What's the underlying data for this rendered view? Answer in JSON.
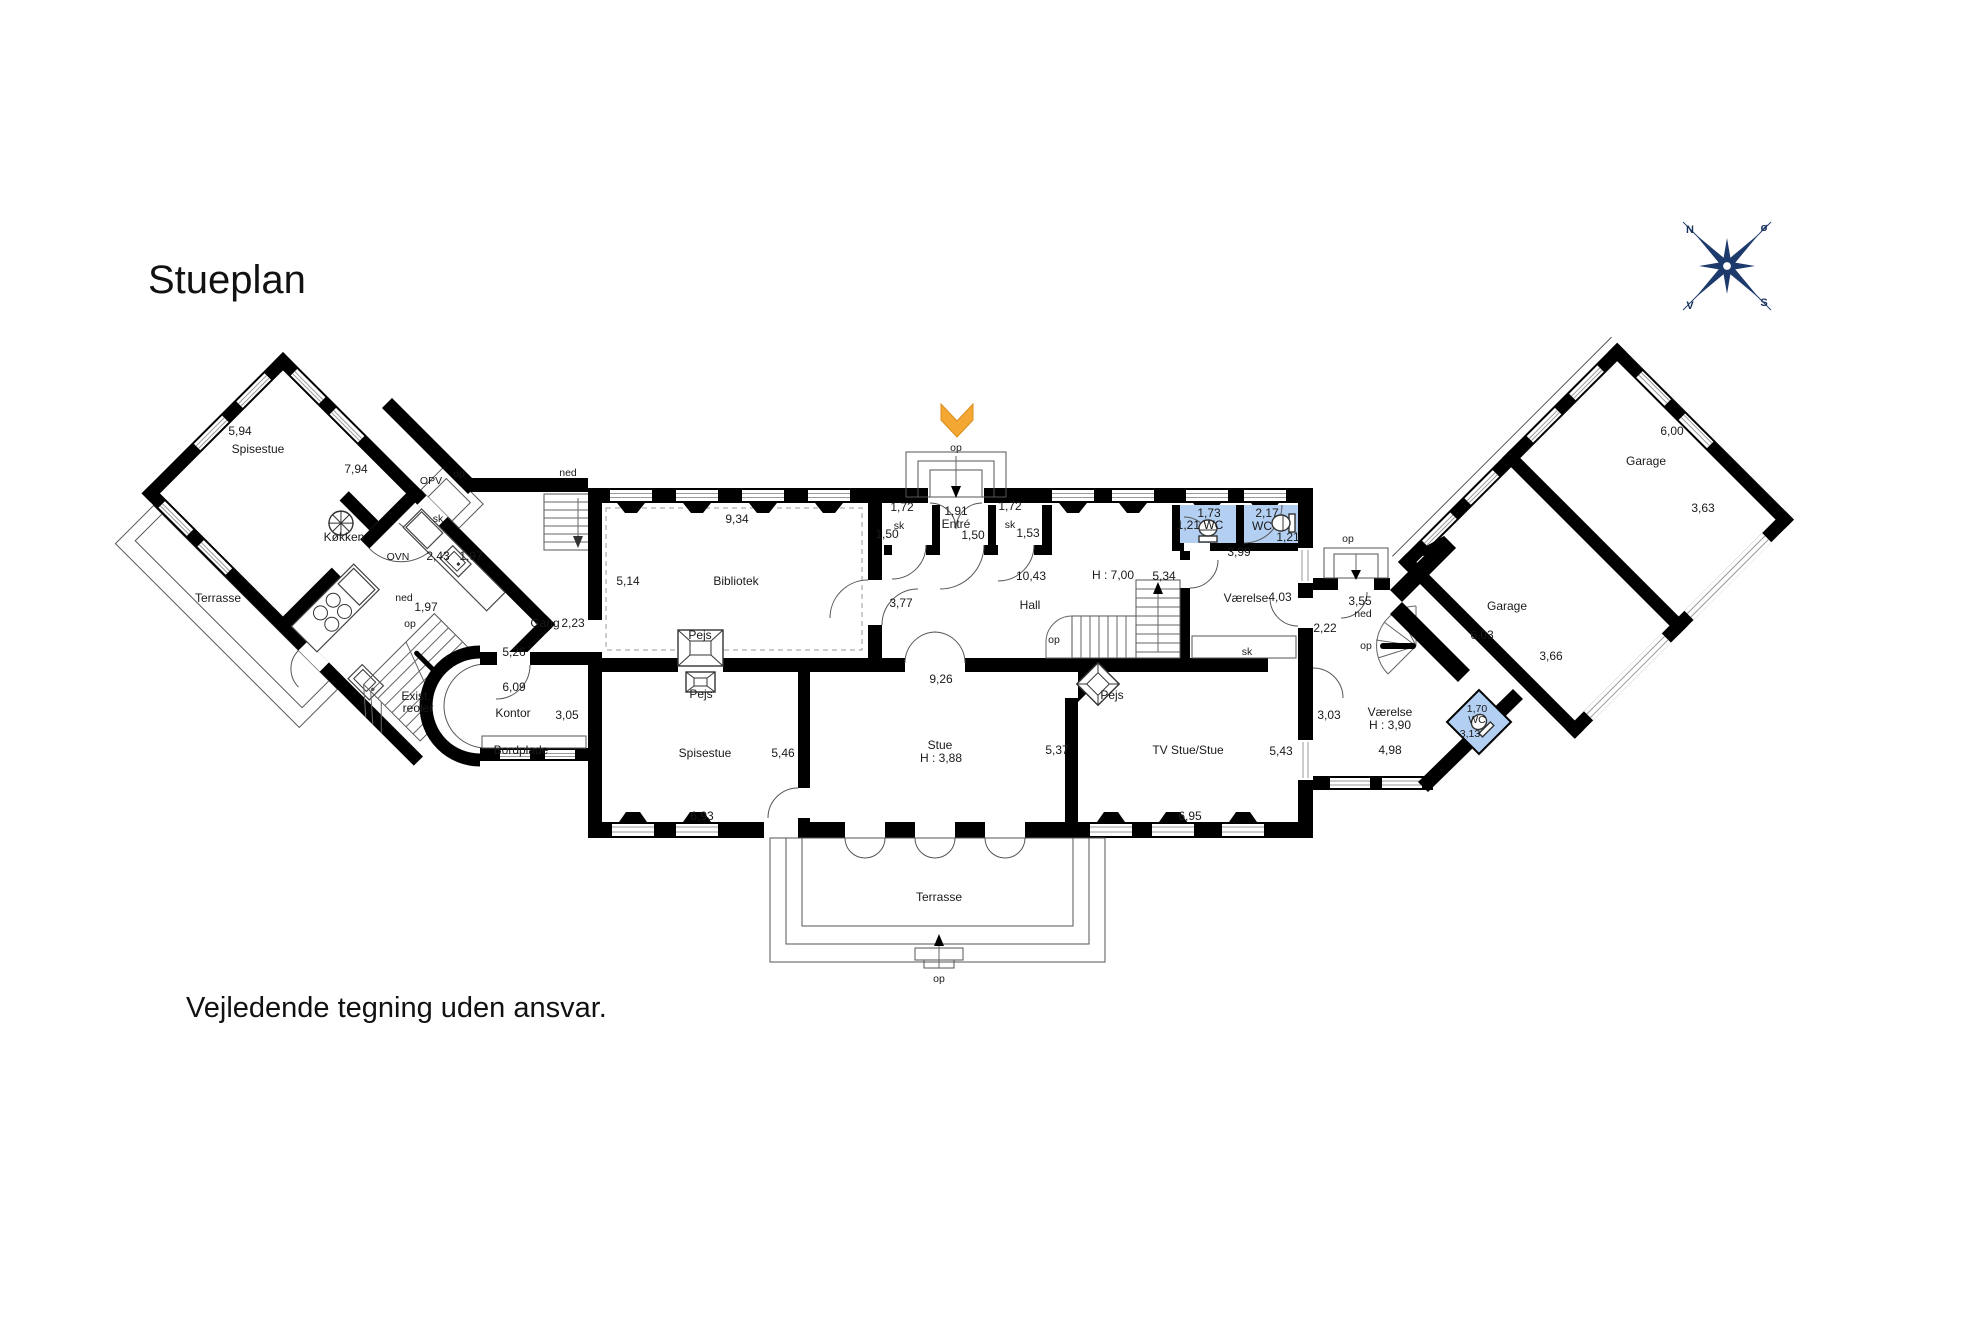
{
  "page": {
    "title": "Stueplan",
    "disclaimer": "Vejledende tegning uden ansvar."
  },
  "compass": {
    "north": "N",
    "east": "ø",
    "south": "S",
    "west": "V"
  },
  "colors": {
    "wall": "#000000",
    "wc_room_fill": "#b3cff2",
    "entrance_marker_orange": "#f4a733",
    "compass_navy": "#1c3a6b"
  },
  "plan": {
    "labels": [
      {
        "n": "dim-spisestue-width",
        "t": "5,94",
        "x": 240,
        "y": 435
      },
      {
        "n": "room-spisestue-wing",
        "t": "Spisestue",
        "x": 258,
        "y": 453
      },
      {
        "n": "dim-spisestue-length",
        "t": "7,94",
        "x": 356,
        "y": 473
      },
      {
        "n": "fixture-opv",
        "t": "OPV",
        "x": 431,
        "y": 484,
        "s": 11
      },
      {
        "n": "room-kokken",
        "t": "Køkken",
        "x": 344,
        "y": 541
      },
      {
        "n": "fixture-ovn",
        "t": "OVN",
        "x": 398,
        "y": 560,
        "s": 11
      },
      {
        "n": "closet-sk-kitchen",
        "t": "sk",
        "x": 438,
        "y": 522,
        "s": 11
      },
      {
        "n": "dim-243",
        "t": "2,43",
        "x": 438,
        "y": 560
      },
      {
        "n": "dim-197a",
        "t": "1,97",
        "x": 471,
        "y": 560
      },
      {
        "n": "stair-ned-kitchen",
        "t": "ned",
        "x": 404,
        "y": 601,
        "s": 11
      },
      {
        "n": "dim-197b",
        "t": "1,97",
        "x": 426,
        "y": 611
      },
      {
        "n": "stair-op-kitchen",
        "t": "op",
        "x": 410,
        "y": 627,
        "s": 11
      },
      {
        "n": "stair-ned-bibliotek",
        "t": "ned",
        "x": 568,
        "y": 476,
        "s": 11
      },
      {
        "n": "entry-op-kitchen",
        "t": "op",
        "x": 459,
        "y": 477,
        "s": 11
      },
      {
        "n": "area-terrasse-wing",
        "t": "Terrasse",
        "x": 218,
        "y": 602
      },
      {
        "n": "room-gang",
        "t": "Gang",
        "x": 545,
        "y": 627
      },
      {
        "n": "dim-gang-223",
        "t": "2,23",
        "x": 573,
        "y": 627
      },
      {
        "n": "dim-526",
        "t": "5,26",
        "x": 514,
        "y": 656
      },
      {
        "n": "dim-609",
        "t": "6,09",
        "x": 514,
        "y": 691
      },
      {
        "n": "note-exist",
        "t": "Exist.",
        "x": 416,
        "y": 700
      },
      {
        "n": "note-reoler",
        "t": "reoler",
        "x": 418,
        "y": 712
      },
      {
        "n": "room-kontor",
        "t": "Kontor",
        "x": 513,
        "y": 717
      },
      {
        "n": "dim-305",
        "t": "3,05",
        "x": 567,
        "y": 719
      },
      {
        "n": "fixture-bordplade",
        "t": "Bordplade",
        "x": 521,
        "y": 754
      },
      {
        "n": "dim-934",
        "t": "9,34",
        "x": 737,
        "y": 523
      },
      {
        "n": "dim-514",
        "t": "5,14",
        "x": 628,
        "y": 585
      },
      {
        "n": "room-bibliotek",
        "t": "Bibliotek",
        "x": 736,
        "y": 585
      },
      {
        "n": "fixture-pejs-bibliotek",
        "t": "Pejs",
        "x": 700,
        "y": 639
      },
      {
        "n": "fixture-pejs-spisestue",
        "t": "Pejs",
        "x": 701,
        "y": 698
      },
      {
        "n": "dim-377",
        "t": "3,77",
        "x": 901,
        "y": 607
      },
      {
        "n": "dim-sk1-172",
        "t": "1,72",
        "x": 902,
        "y": 511
      },
      {
        "n": "closet-sk1",
        "t": "sk",
        "x": 899,
        "y": 529,
        "s": 11
      },
      {
        "n": "dim-sk1-150",
        "t": "1,50",
        "x": 887,
        "y": 538
      },
      {
        "n": "dim-entre-191",
        "t": "1,91",
        "x": 956,
        "y": 515
      },
      {
        "n": "room-entre",
        "t": "Entré",
        "x": 956,
        "y": 528
      },
      {
        "n": "dim-entre-150",
        "t": "1,50",
        "x": 973,
        "y": 539
      },
      {
        "n": "dim-sk2-172",
        "t": "1,72",
        "x": 1010,
        "y": 510
      },
      {
        "n": "closet-sk2",
        "t": "sk",
        "x": 1010,
        "y": 528,
        "s": 11
      },
      {
        "n": "dim-sk2-153",
        "t": "1,53",
        "x": 1028,
        "y": 537
      },
      {
        "n": "entry-op-main",
        "t": "op",
        "x": 956,
        "y": 451,
        "s": 11
      },
      {
        "n": "dim-1043",
        "t": "10,43",
        "x": 1031,
        "y": 580
      },
      {
        "n": "room-hall",
        "t": "Hall",
        "x": 1030,
        "y": 609
      },
      {
        "n": "dim-h700",
        "t": "H : 7,00",
        "x": 1113,
        "y": 579
      },
      {
        "n": "dim-534",
        "t": "5,34",
        "x": 1164,
        "y": 580
      },
      {
        "n": "stair-op-hall",
        "t": "op",
        "x": 1054,
        "y": 643,
        "s": 11
      },
      {
        "n": "dim-wc1-173",
        "t": "1,73",
        "x": 1209,
        "y": 517
      },
      {
        "n": "room-wc1",
        "t": "1,21 WC",
        "x": 1200,
        "y": 529
      },
      {
        "n": "dim-wc2-217",
        "t": "2,17",
        "x": 1267,
        "y": 517
      },
      {
        "n": "room-wc2",
        "t": "WC",
        "x": 1262,
        "y": 530
      },
      {
        "n": "dim-wc2-121",
        "t": "1,21",
        "x": 1288,
        "y": 541
      },
      {
        "n": "dim-399",
        "t": "3,99",
        "x": 1239,
        "y": 556
      },
      {
        "n": "room-vaerelse-1",
        "t": "Værelse",
        "x": 1246,
        "y": 602
      },
      {
        "n": "dim-403",
        "t": "4,03",
        "x": 1280,
        "y": 601
      },
      {
        "n": "dim-222",
        "t": "2,22",
        "x": 1325,
        "y": 632
      },
      {
        "n": "closet-sk3",
        "t": "sk",
        "x": 1247,
        "y": 655,
        "s": 11
      },
      {
        "n": "entry-op-right",
        "t": "op",
        "x": 1348,
        "y": 542,
        "s": 11
      },
      {
        "n": "dim-355",
        "t": "3,55",
        "x": 1360,
        "y": 605
      },
      {
        "n": "stair-ned-right",
        "t": "ned",
        "x": 1363,
        "y": 617,
        "s": 11
      },
      {
        "n": "stair-op-right",
        "t": "op",
        "x": 1366,
        "y": 649,
        "s": 11
      },
      {
        "n": "room-spisestue-main",
        "t": "Spisestue",
        "x": 705,
        "y": 757
      },
      {
        "n": "dim-546",
        "t": "5,46",
        "x": 783,
        "y": 757
      },
      {
        "n": "dim-693",
        "t": "6,93",
        "x": 702,
        "y": 820
      },
      {
        "n": "dim-926",
        "t": "9,26",
        "x": 941,
        "y": 683
      },
      {
        "n": "room-stue",
        "t": "Stue",
        "x": 940,
        "y": 749
      },
      {
        "n": "dim-h388",
        "t": "H : 3,88",
        "x": 941,
        "y": 762
      },
      {
        "n": "dim-537",
        "t": "5,37",
        "x": 1057,
        "y": 754
      },
      {
        "n": "fixture-pejs-tvstue",
        "t": "Pejs",
        "x": 1112,
        "y": 699
      },
      {
        "n": "room-tvstue",
        "t": "TV Stue/Stue",
        "x": 1188,
        "y": 754
      },
      {
        "n": "dim-543",
        "t": "5,43",
        "x": 1281,
        "y": 755
      },
      {
        "n": "dim-695",
        "t": "6,95",
        "x": 1190,
        "y": 820
      },
      {
        "n": "area-terrasse-main",
        "t": "Terrasse",
        "x": 939,
        "y": 901
      },
      {
        "n": "terrace-op",
        "t": "op",
        "x": 939,
        "y": 982,
        "s": 11
      },
      {
        "n": "dim-303",
        "t": "3,03",
        "x": 1329,
        "y": 719
      },
      {
        "n": "room-vaerelse-2",
        "t": "Værelse",
        "x": 1390,
        "y": 716
      },
      {
        "n": "dim-h390",
        "t": "H : 3,90",
        "x": 1390,
        "y": 729
      },
      {
        "n": "dim-498",
        "t": "4,98",
        "x": 1390,
        "y": 754
      },
      {
        "n": "dim-wc3-170",
        "t": "1,70",
        "x": 1477,
        "y": 712,
        "s": 11
      },
      {
        "n": "room-wc3",
        "t": "WC",
        "x": 1477,
        "y": 723,
        "s": 11
      },
      {
        "n": "dim-wc3-313",
        "t": "3,13",
        "x": 1470,
        "y": 737,
        "s": 11
      },
      {
        "n": "room-garage-1",
        "t": "Garage",
        "x": 1507,
        "y": 610
      },
      {
        "n": "dim-603",
        "t": "6,03",
        "x": 1482,
        "y": 639
      },
      {
        "n": "dim-366",
        "t": "3,66",
        "x": 1551,
        "y": 660
      },
      {
        "n": "room-garage-2",
        "t": "Garage",
        "x": 1646,
        "y": 465
      },
      {
        "n": "dim-600",
        "t": "6,00",
        "x": 1672,
        "y": 435
      },
      {
        "n": "dim-363",
        "t": "3,63",
        "x": 1703,
        "y": 512
      }
    ]
  }
}
